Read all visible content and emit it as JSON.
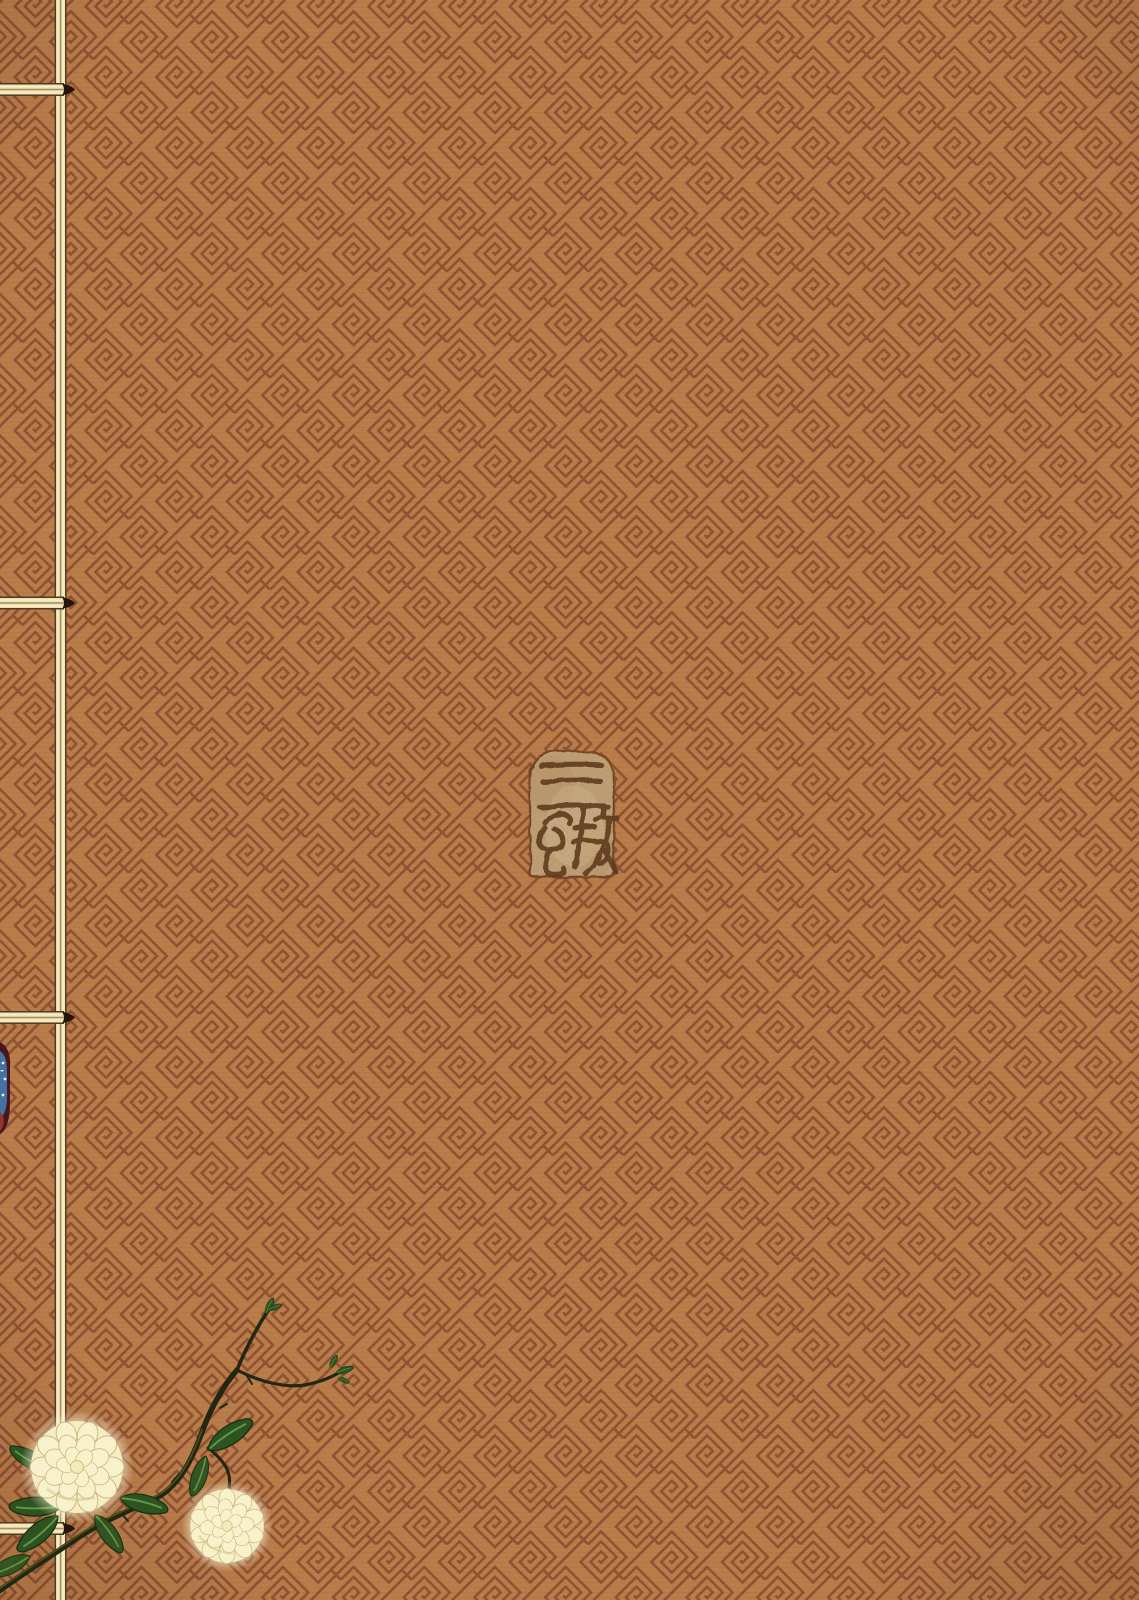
{
  "cover": {
    "fabric_color": "#c2834e",
    "pattern_line_color": "#8c4c31",
    "pattern_name": "diagonal-key-fret-weave"
  },
  "binding": {
    "thread_color": "#ecdfb4",
    "stitch_count": 4,
    "knot_color": "#241409"
  },
  "seal": {
    "text": "三色坊",
    "background_color": "#d4b284",
    "ink_color": "#5f3b1d"
  },
  "flowers": {
    "name": "white-chrysanthemum-spray",
    "petal_color": "#f8f2cc",
    "petal_base_color": "#f5eec2",
    "leaf_color": "#2d5322",
    "branch_color": "#23270f",
    "bud_color": "#4e8c36",
    "count": 2
  },
  "peek": {
    "name": "under-cover-fabric-glimpse",
    "blue": "#44719f",
    "red": "#93362f",
    "maroon": "#4a161d"
  }
}
